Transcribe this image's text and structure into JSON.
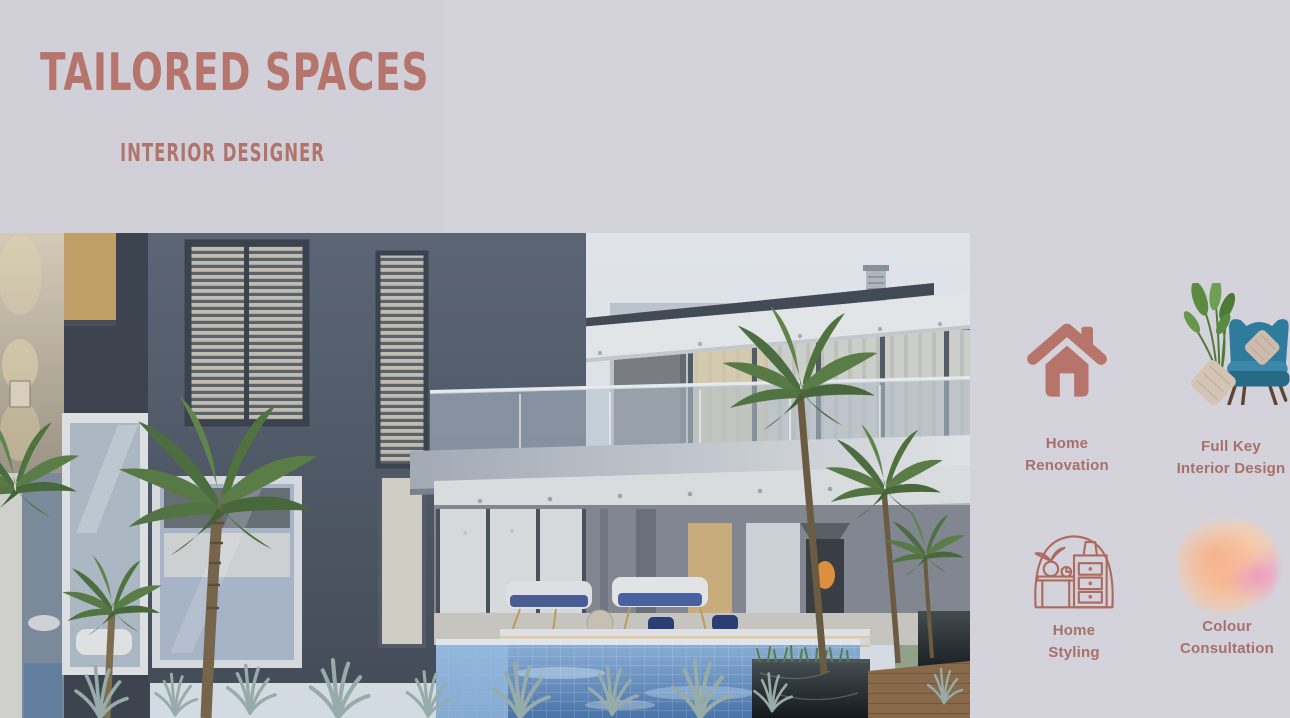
{
  "brand": {
    "title": "TAILORED SPACES",
    "subtitle": "INTERIOR DESIGNER"
  },
  "services": [
    {
      "id": "home-renovation",
      "icon": "home-icon",
      "lines": [
        "Home",
        "Renovation"
      ]
    },
    {
      "id": "full-key-interior-design",
      "icon": "armchair-plant-image",
      "lines": [
        "Full Key",
        "Interior Design"
      ]
    },
    {
      "id": "home-styling",
      "icon": "furniture-line-icon",
      "lines": [
        "Home",
        "Styling"
      ]
    },
    {
      "id": "colour-consultation",
      "icon": "watercolor-blob-icon",
      "lines": [
        "Colour",
        "Consultation"
      ]
    }
  ],
  "colors": {
    "background": "#d4d3dc",
    "left_panel": "#d1d0d9",
    "accent_terracotta": "#b5756c",
    "label_text": "#a8706a",
    "line_icon_stroke": "#ad6a5e",
    "chair_blue": "#2f7b9b",
    "watercolor_peach": "#f6b18b",
    "watercolor_pink": "#ee97c0"
  }
}
